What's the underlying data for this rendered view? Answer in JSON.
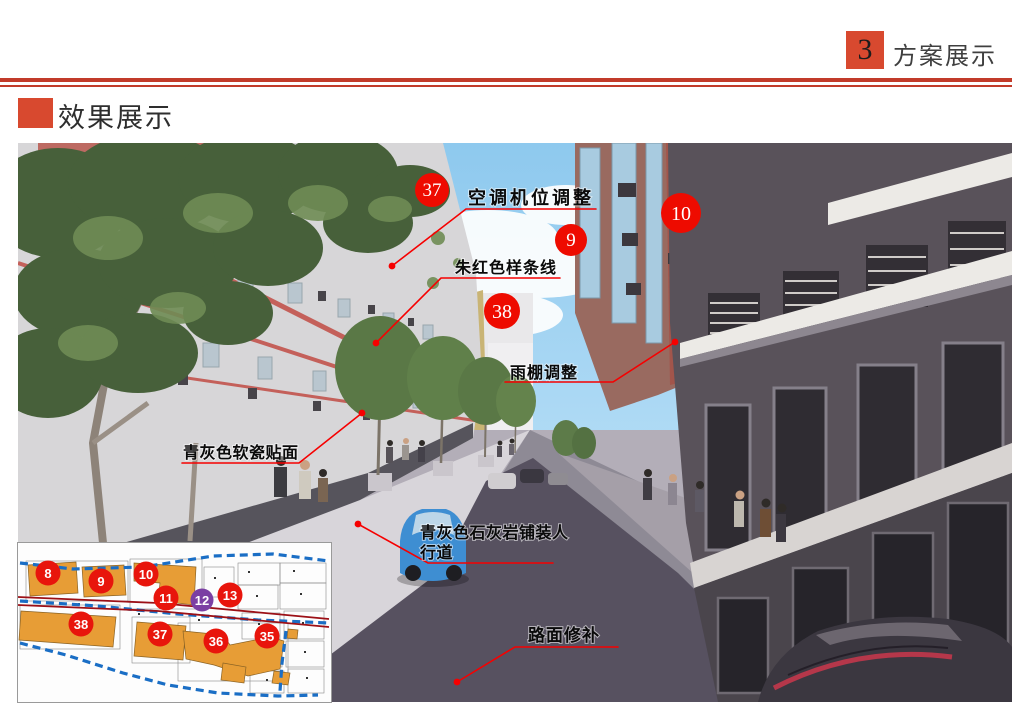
{
  "header": {
    "section_number": "3",
    "section_title": "方案展示"
  },
  "section": {
    "title": "效果展示"
  },
  "colors": {
    "accent_red": "#d8492f",
    "rule_red": "#c23b2a",
    "marker_red": "#ee0b00",
    "marker_purple": "#7b3fa3",
    "leader_red": "#f60000",
    "map_building_orange": "#e79d36",
    "map_road_blue": "#1a6ec5",
    "map_line_dark_red": "#9c1016"
  },
  "photo": {
    "markers": [
      {
        "number": "37"
      },
      {
        "number": "9"
      },
      {
        "number": "10"
      },
      {
        "number": "38"
      }
    ],
    "labels": {
      "aircon": "空调机位调整",
      "vermilion_spline": "朱红色样条线",
      "canopy": "雨棚调整",
      "facade_tile": "青灰色软瓷贴面",
      "pavement_line1": "青灰色石灰岩铺装人",
      "pavement_line2": "行道",
      "road_repair": "路面修补"
    }
  },
  "inset_map": {
    "markers": [
      {
        "number": "8"
      },
      {
        "number": "9"
      },
      {
        "number": "10"
      },
      {
        "number": "11"
      },
      {
        "number": "12"
      },
      {
        "number": "13"
      },
      {
        "number": "38"
      },
      {
        "number": "37"
      },
      {
        "number": "36"
      },
      {
        "number": "35"
      }
    ]
  }
}
